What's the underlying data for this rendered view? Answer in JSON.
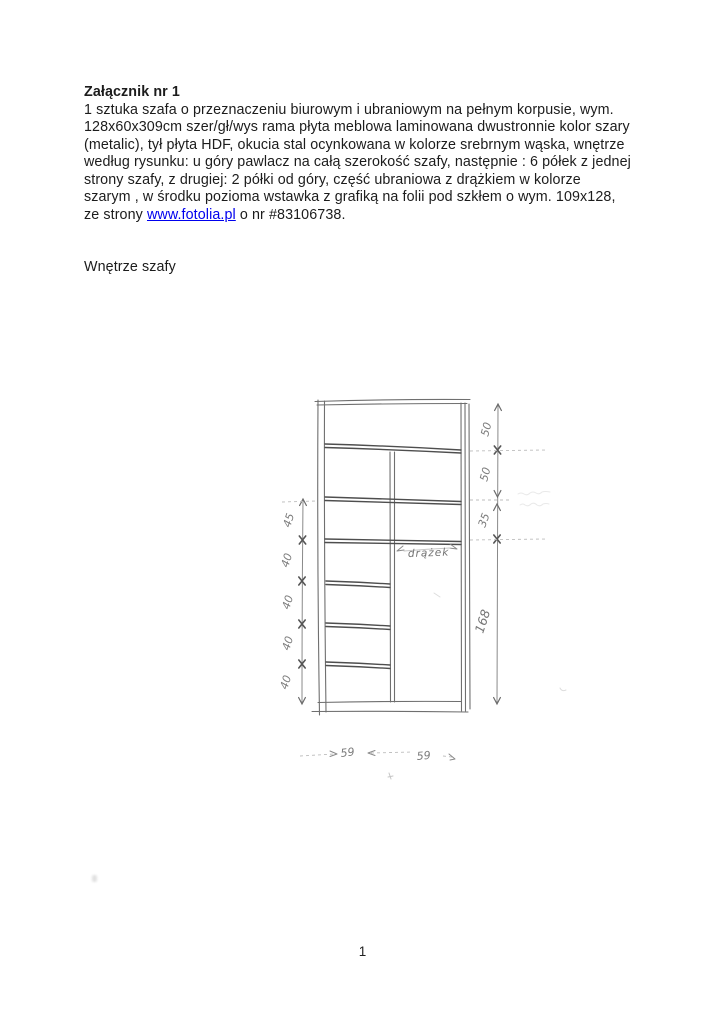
{
  "attachment": {
    "title": "Załącznik nr 1",
    "body_lines": [
      "1 sztuka szafa o przeznaczeniu biurowym i ubraniowym na pełnym korpusie, wym.",
      "128x60x309cm szer/gł/wys rama płyta meblowa laminowana dwustronnie kolor szary",
      "(metalic), tył płyta HDF, okucia stal ocynkowana w kolorze srebrnym wąska, wnętrze",
      "według rysunku: u góry pawlacz na całą szerokość szafy, następnie : 6 półek z jednej",
      "strony szafy, z drugiej: 2 półki od góry, część ubraniowa z drążkiem w kolorze",
      "szarym , w środku pozioma wstawka z grafiką na folii pod szkłem o wym. 109x128,"
    ],
    "last_line_prefix": "ze strony ",
    "link_text": "www.fotolia.pl",
    "last_line_suffix": " o nr #83106738.",
    "subheading": "Wnętrze szafy"
  },
  "drawing": {
    "rod_label": "drążek",
    "left_dims": [
      "45",
      "40",
      "40",
      "40",
      "40"
    ],
    "right_dims": [
      "50",
      "50",
      "35",
      "168"
    ],
    "bottom_dims": [
      "59",
      "59"
    ]
  },
  "footer": {
    "page_number": "1"
  },
  "colors": {
    "link": "#0000ee",
    "ink": "#1c1c1c",
    "pencil": "#6f6f6f"
  }
}
